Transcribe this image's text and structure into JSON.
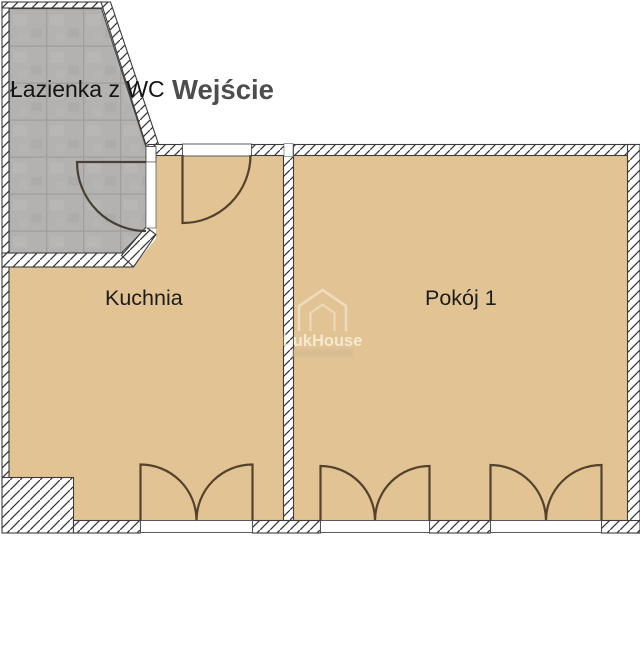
{
  "plan": {
    "type": "apartment-floor-plan",
    "rooms": {
      "bathroom": "Łazienka z WC",
      "kitchen": "Kuchnia",
      "room1": "Pokój 1"
    },
    "entrance": {
      "label": "Wejście"
    },
    "watermark": {
      "brand": "LukHouse"
    },
    "colors": {
      "floor": "#e2c394",
      "bathroom_tiles": "#b4b2b0",
      "tile_grout": "#a09e9c",
      "wall_fill": "#ffffff",
      "wall_hatch": "#343434",
      "wall_outline": "#3c3c3c",
      "door_arc": "#53432c",
      "label_text": "#1d1d1d",
      "entrance_text": "#4d4d4d",
      "background": "#ffffff"
    }
  }
}
